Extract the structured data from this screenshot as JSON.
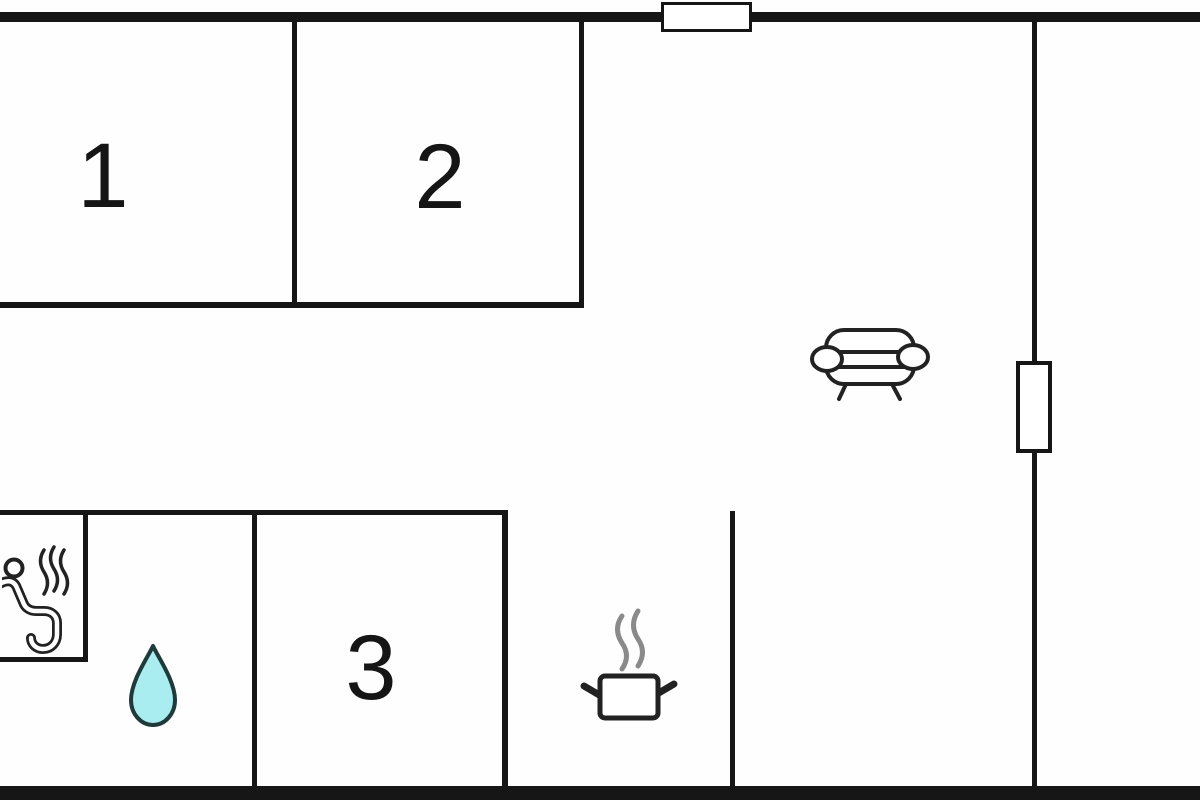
{
  "rooms": [
    {
      "label": "1"
    },
    {
      "label": "2"
    },
    {
      "label": "3"
    }
  ],
  "icons": {
    "sauna": "sauna-icon",
    "water_drop": "water-drop-icon",
    "sofa": "sofa-icon",
    "cooking_pot": "cooking-pot-icon"
  },
  "features": {
    "top_window": "window",
    "right_wall_door": "door"
  },
  "colors": {
    "wall": "#161616",
    "background": "#ffffff",
    "drop_fill": "#a9edf1",
    "drop_stroke": "#1f3a3a",
    "steam_gray": "#8a8a8a",
    "icon_stroke": "#222222"
  }
}
